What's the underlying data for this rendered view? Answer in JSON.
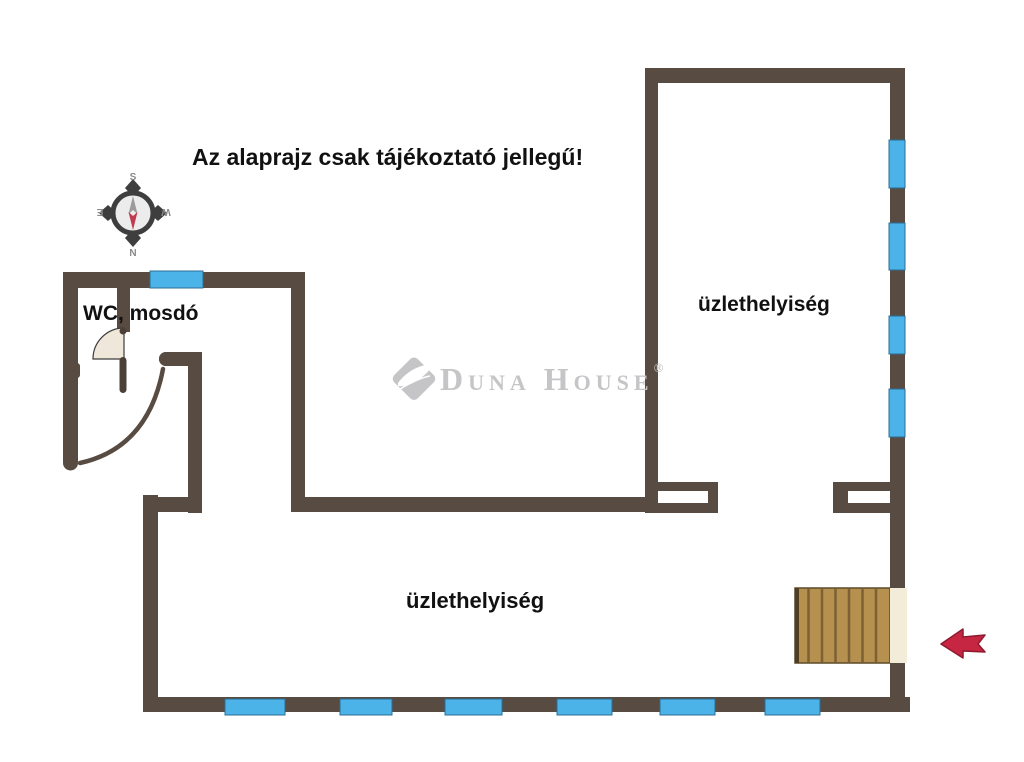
{
  "title": "Az alaprajz csak tájékoztató jellegű!",
  "labels": {
    "wc": "WC, mosdó",
    "shop_top": "üzlethelyiség",
    "shop_bottom": "üzlethelyiség"
  },
  "compass": {
    "top": "S",
    "bottom": "N",
    "left": "E",
    "right": "W"
  },
  "watermark": {
    "brand": "Duna House",
    "registered": "®"
  },
  "colors": {
    "wall": "#574b42",
    "window": "#4cb3e9",
    "stairs_wood": "#b5904e",
    "stairs_stripe": "#7d6134",
    "landing_cream": "#f3ecd9",
    "arrow_red": "#c62641",
    "arrow_red_dark": "#8e1b30",
    "logo_gray": "#c5c5c8",
    "door_leaf": "#efe8da",
    "compass_letter": "#8a8a8a",
    "text_black": "#111111"
  }
}
